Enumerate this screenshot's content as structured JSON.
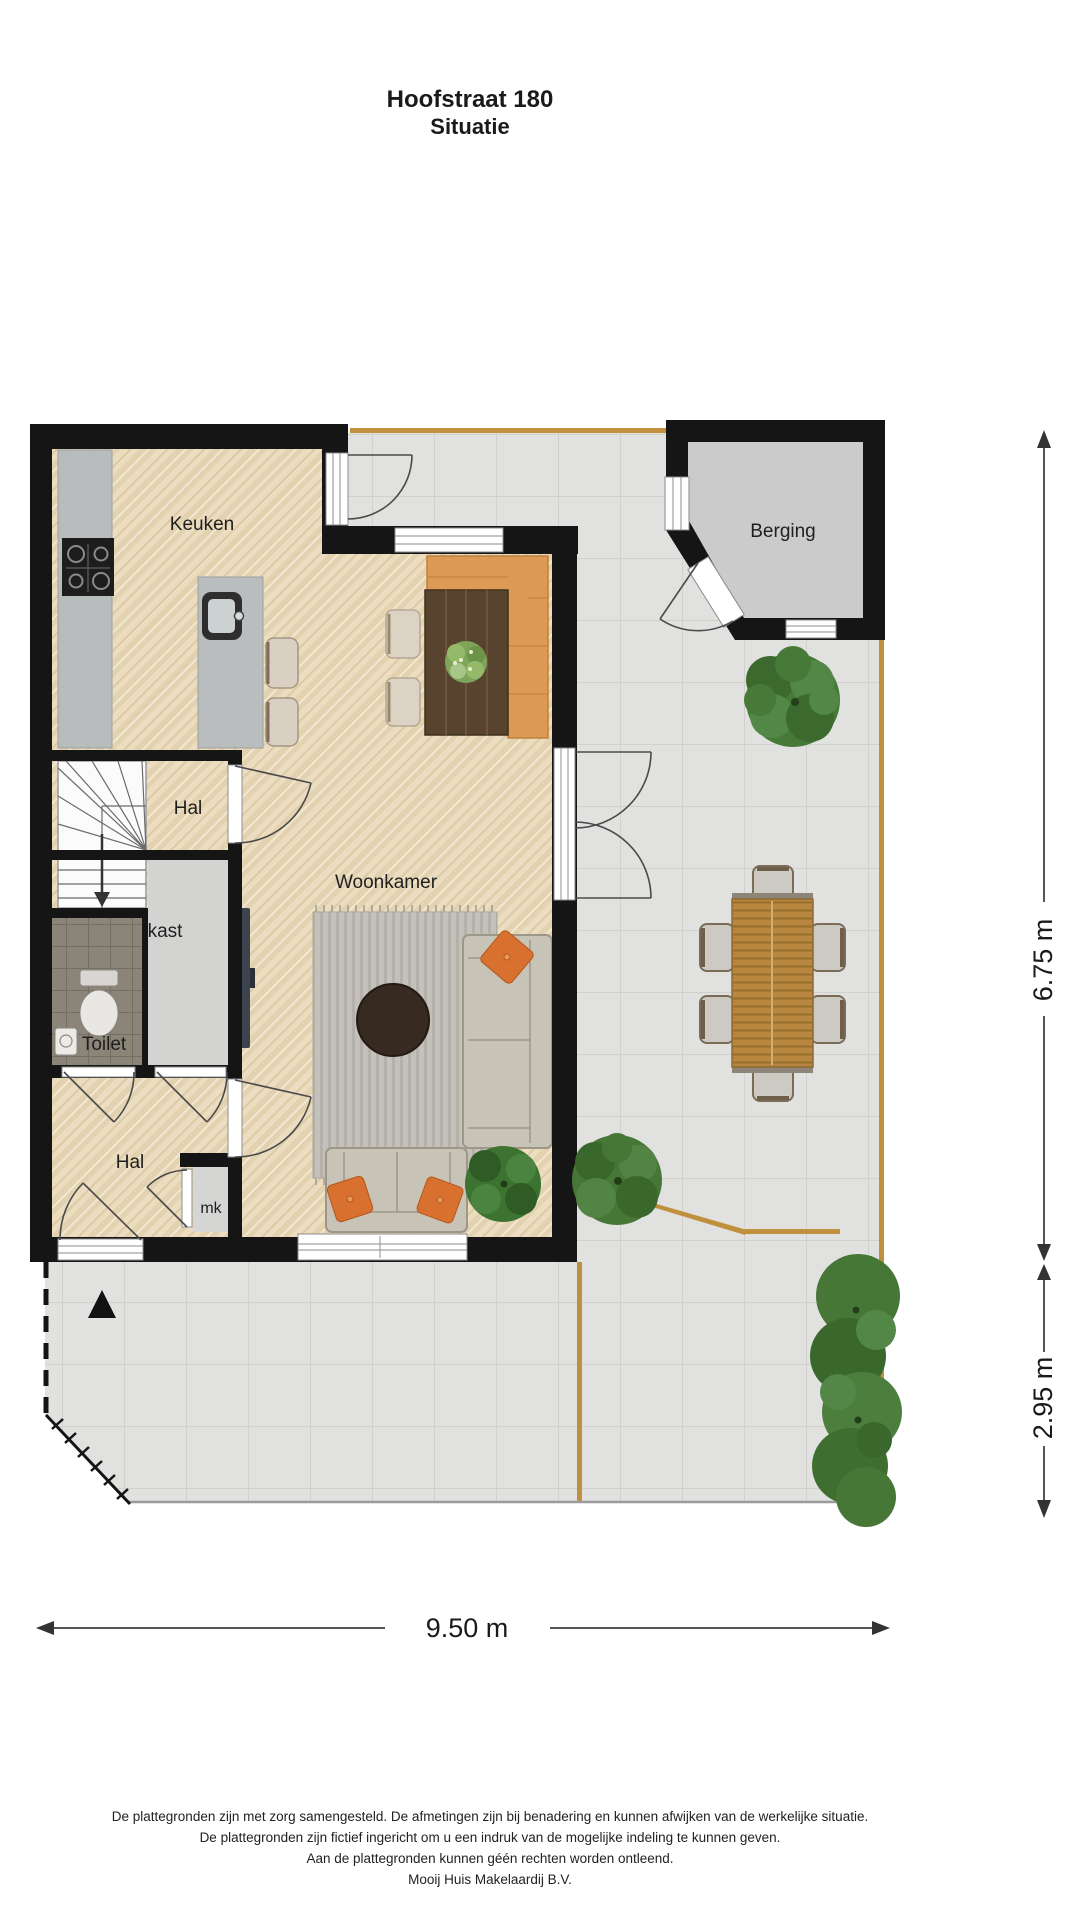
{
  "title": {
    "address": "Hoofstraat 180",
    "subtitle": "Situatie"
  },
  "floor_plan": {
    "rooms": {
      "keuken": "Keuken",
      "berging": "Berging",
      "hal_upper": "Hal",
      "kast": "kast",
      "toilet": "Toilet",
      "hal_lower": "Hal",
      "mk": "mk",
      "woonkamer": "Woonkamer"
    },
    "dimensions": {
      "garden_depth": "6.75 m",
      "front_garden_depth": "2.95 m",
      "plot_width": "9.50 m"
    }
  },
  "colors": {
    "wall": "#151515",
    "wood_floor": "#ecddc1",
    "terrace_tile": "#e1e1df",
    "storage_floor": "#cbcbcb",
    "fence_wood": "#c0903e",
    "bench_leather": "#dd9a55",
    "sofa_grey": "#c7c3b6",
    "pillow_orange": "#d8702f",
    "plant_green": "#4c7c3c"
  },
  "disclaimer": {
    "line1": "De plattegronden zijn met zorg samengesteld. De afmetingen zijn bij benadering en kunnen afwijken van de werkelijke situatie.",
    "line2": "De plattegronden zijn fictief ingericht om u een indruk van de mogelijke indeling te kunnen geven.",
    "line3": "Aan de plattegronden kunnen géén rechten worden ontleend.",
    "line4": "Mooij Huis Makelaardij B.V."
  }
}
